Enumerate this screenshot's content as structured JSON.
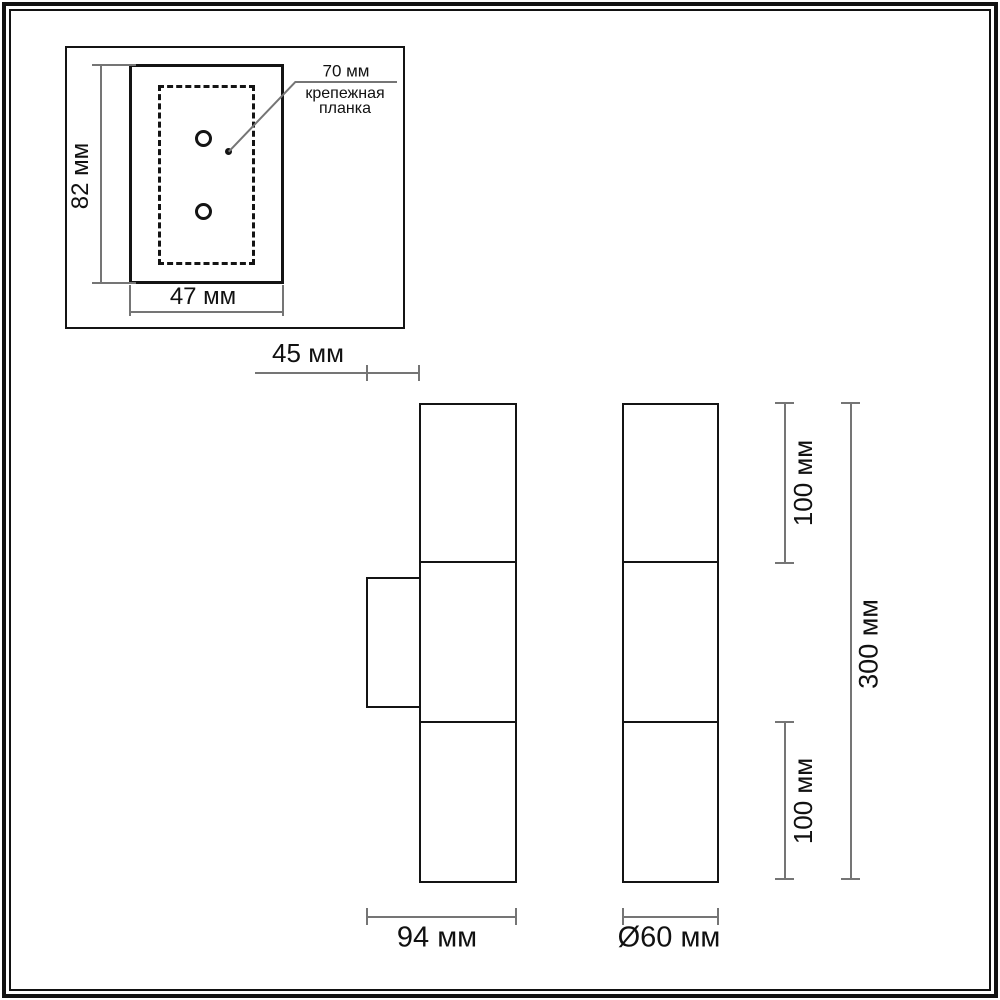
{
  "drawing": {
    "mount_plate": {
      "height_dim": "82 мм",
      "width_dim": "47 мм",
      "bracket_dim": "70 мм",
      "bracket_label_line1": "крепежная",
      "bracket_label_line2": "планка"
    },
    "side_view": {
      "wall_offset_dim": "45 мм",
      "depth_dim": "94 мм"
    },
    "front_view": {
      "diameter_dim": "Ø60 мм",
      "upper_shade_dim": "100 мм",
      "lower_shade_dim": "100 мм",
      "overall_height_dim": "300 мм"
    },
    "colors": {
      "outline": "#141414",
      "dim_line": "#757575",
      "background": "#ffffff"
    }
  }
}
